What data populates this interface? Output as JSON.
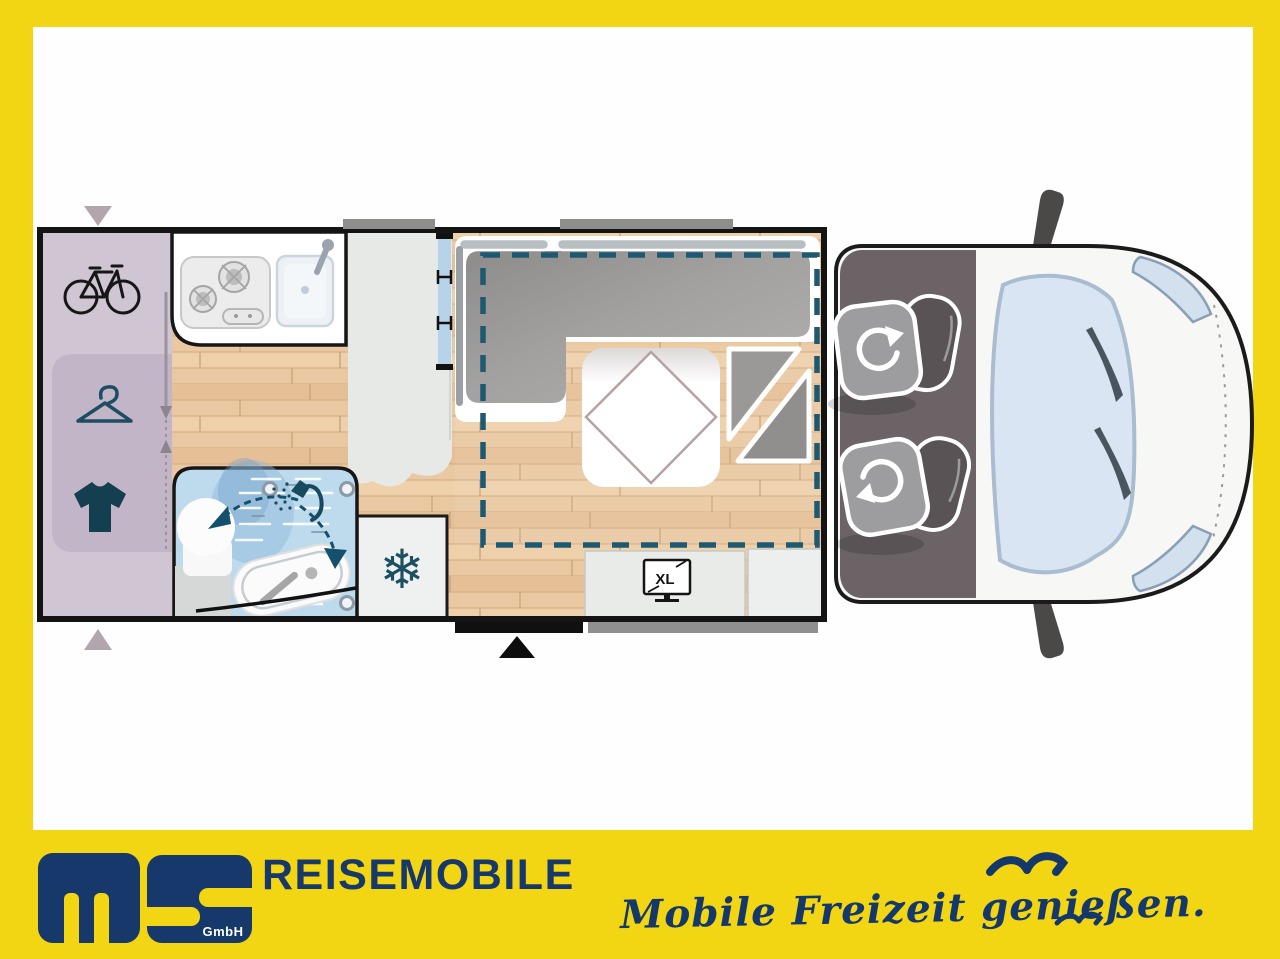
{
  "window": {
    "width": 1280,
    "height": 959
  },
  "branding": {
    "logo_monogram": "ms",
    "logo_suffix": "GmbH",
    "company_name": "REISEMOBILE",
    "tagline": "Mobile Freizeit genießen.",
    "colors": {
      "navy": "#17386b",
      "yellow": "#f2d513"
    }
  },
  "floorplan": {
    "type": "motorhome-top-view-layout",
    "tv_badge": "XL",
    "fridge_icon_glyph": "❄",
    "icons": [
      "bicycle-icon",
      "clothes-hanger-icon",
      "shirt-icon",
      "stove-icon",
      "sink-icon",
      "snowflake-icon",
      "shower-icon",
      "toilet-icon",
      "tv-xl-icon",
      "swivel-seat-icon",
      "entry-arrow-icon",
      "drop-down-bed-outline"
    ],
    "colors": {
      "wood_floor": "#eac8a1",
      "garage": "#cfc5d3",
      "wardrobe": "#c2b5c8",
      "bathroom_blue": "#bedbee",
      "cushion_gray": "#a2a1a0",
      "cab_floor": "#6c6366",
      "bed_outline_teal": "#1d5a71",
      "icon_teal": "#174a5f",
      "wall_black": "#141414",
      "window_blue": "#b6d3ea",
      "vehicle_white": "#f7f7f5",
      "glass_blue": "#d9e5f2"
    }
  }
}
